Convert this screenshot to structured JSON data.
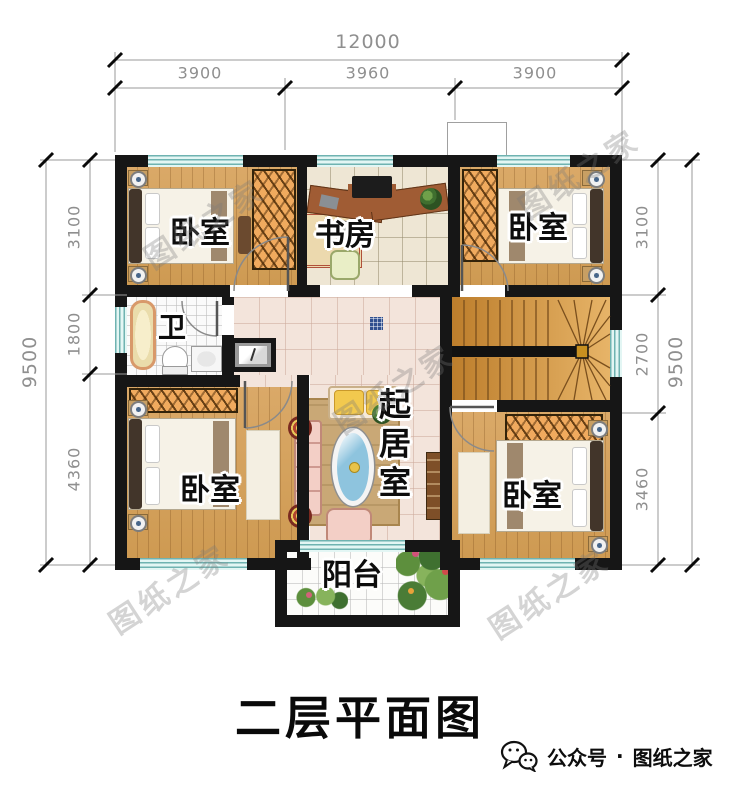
{
  "watermark": {
    "text": "图纸之家"
  },
  "plan": {
    "rooms": {
      "bedroom_tl": "卧室",
      "study": "书房",
      "bedroom_tr": "卧室",
      "bathroom": "卫",
      "living": "起居室",
      "bedroom_bl": "卧室",
      "bedroom_br": "卧室",
      "balcony": "阳台"
    }
  },
  "dimensions": {
    "top": {
      "total": "12000",
      "segments": [
        "3900",
        "3960",
        "3900"
      ]
    },
    "left": {
      "total": "9500",
      "segments": [
        "3100",
        "1800",
        "4360"
      ]
    },
    "right": {
      "total": "9500",
      "segments": [
        "3100",
        "2700",
        "3460"
      ]
    }
  },
  "title": "二层平面图",
  "footer": {
    "icon": "wechat-icon",
    "channel": "公众号",
    "separator": "·",
    "brand": "图纸之家"
  },
  "colors": {
    "wall": "#161616",
    "window_fill": "#e3f6f4",
    "window_line": "#6fb3b1",
    "wood_floor": "#d7a55f",
    "study_tile": "#eee6d4",
    "hall_tile": "#f3e4db",
    "stair_wood": "#c8862f",
    "wardrobe": "#f0aa5e",
    "dim_text": "#8f8f8f",
    "label_text": "#0d0d0d"
  }
}
